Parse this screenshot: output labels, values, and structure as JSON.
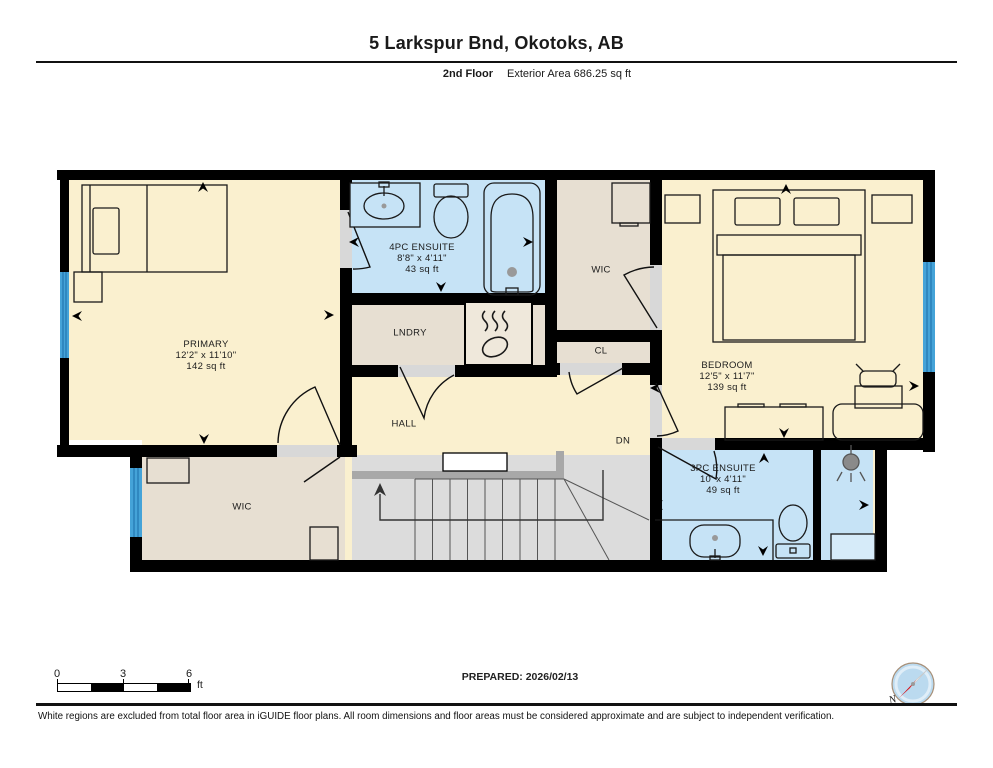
{
  "header": {
    "title": "5 Larkspur Bnd, Okotoks, AB",
    "floor_label": "2nd Floor",
    "area_label": "Exterior Area 686.25 sq ft"
  },
  "rooms": {
    "primary": {
      "name": "PRIMARY",
      "dims": "12'2\" x 11'10\"",
      "area": "142 sq ft"
    },
    "ensuite_4pc": {
      "name": "4PC ENSUITE",
      "dims": "8'8\" x 4'11\"",
      "area": "43 sq ft"
    },
    "wic_upper": {
      "name": "WIC"
    },
    "laundry": {
      "name": "LNDRY"
    },
    "closet": {
      "name": "CL"
    },
    "bedroom": {
      "name": "BEDROOM",
      "dims": "12'5\" x 11'7\"",
      "area": "139 sq ft"
    },
    "hall": {
      "name": "HALL"
    },
    "stairs": {
      "down_label": "DN"
    },
    "wic_lower": {
      "name": "WIC"
    },
    "ensuite_3pc": {
      "name": "3PC ENSUITE",
      "dims": "10' x 4'11\"",
      "area": "49 sq ft"
    }
  },
  "scale_bar": {
    "tick_0": "0",
    "tick_3": "3",
    "tick_6": "6",
    "unit": "ft"
  },
  "compass": {
    "north_label": "N"
  },
  "footer": {
    "prepared": "PREPARED: 2026/02/13",
    "disclaimer": "White regions are excluded from total floor area in iGUIDE floor plans. All room dimensions and floor areas must be considered approximate and are subject to independent verification."
  },
  "colors": {
    "room_cream": "#FAF0CF",
    "room_bath_blue": "#C6E3F6",
    "room_tan": "#E7DFD2",
    "stairs_grey": "#DCDCDC",
    "door_gap_grey": "#D8D8D8",
    "window_blue": "#45A3D8",
    "wall_black": "#000000",
    "compass_face": "#BBDAEF",
    "compass_needle_red": "#D6121C"
  }
}
